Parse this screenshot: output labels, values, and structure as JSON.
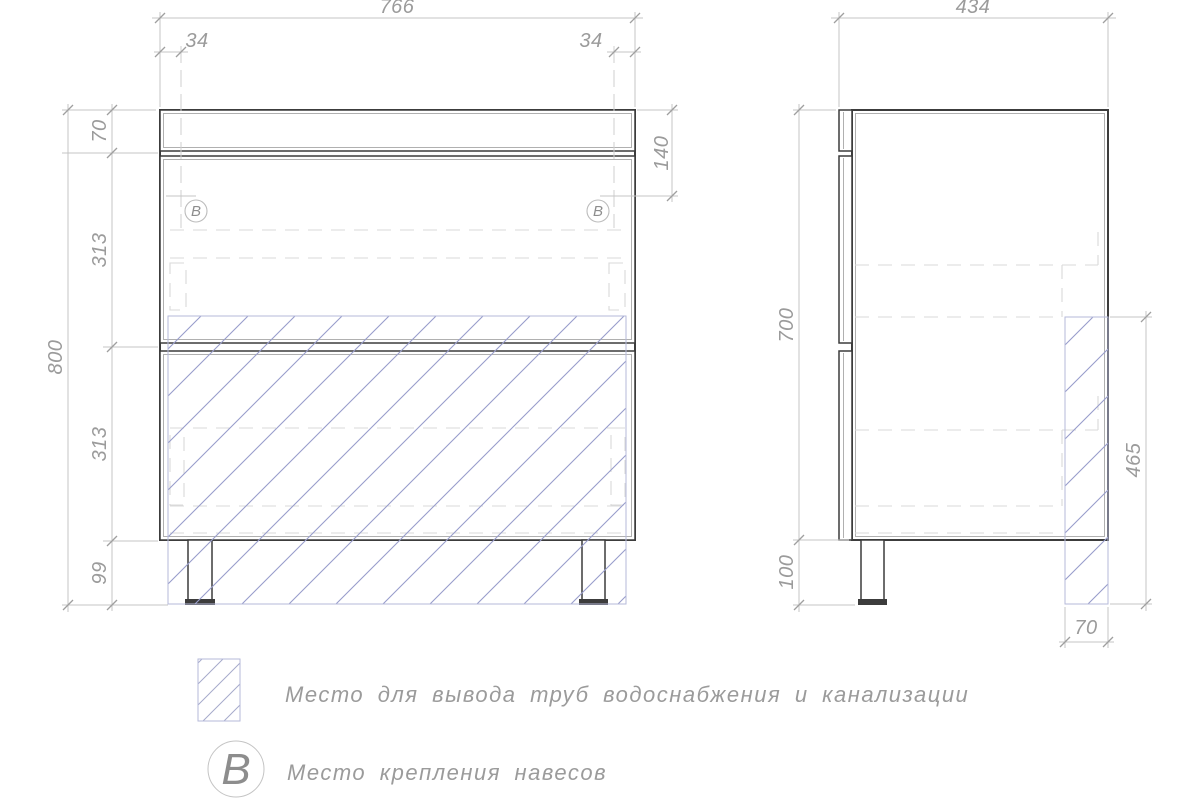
{
  "drawing": {
    "title": "furniture technical drawing - bathroom vanity cabinet",
    "views": {
      "front": {
        "dim_width": "766",
        "dim_mount_inset_left": "34",
        "dim_mount_inset_right": "34",
        "dim_top_drawer_height": "70",
        "dim_mount_offset_from_top": "140",
        "dim_upper_section_height": "313",
        "dim_lower_section_height": "313",
        "dim_leg_height": "99",
        "dim_total_height": "800",
        "mount_marker": "B"
      },
      "side": {
        "dim_depth": "434",
        "dim_body_height": "700",
        "dim_leg_height": "100",
        "dim_pipe_zone_height": "465",
        "dim_pipe_zone_depth": "70"
      }
    },
    "legend": {
      "pipe_zone_label": "Место для вывода труб водоснабжения и канализации",
      "mount_marker": "B",
      "mount_label": "Место крепления навесов"
    },
    "colors": {
      "outline": "#3c3c3c",
      "dimension_line": "#c4c4c4",
      "dimension_text": "#9b9b9b",
      "hatch_line": "#989dcb",
      "hatch_border": "#b6bada",
      "hidden_line": "#d9d9d9"
    }
  }
}
